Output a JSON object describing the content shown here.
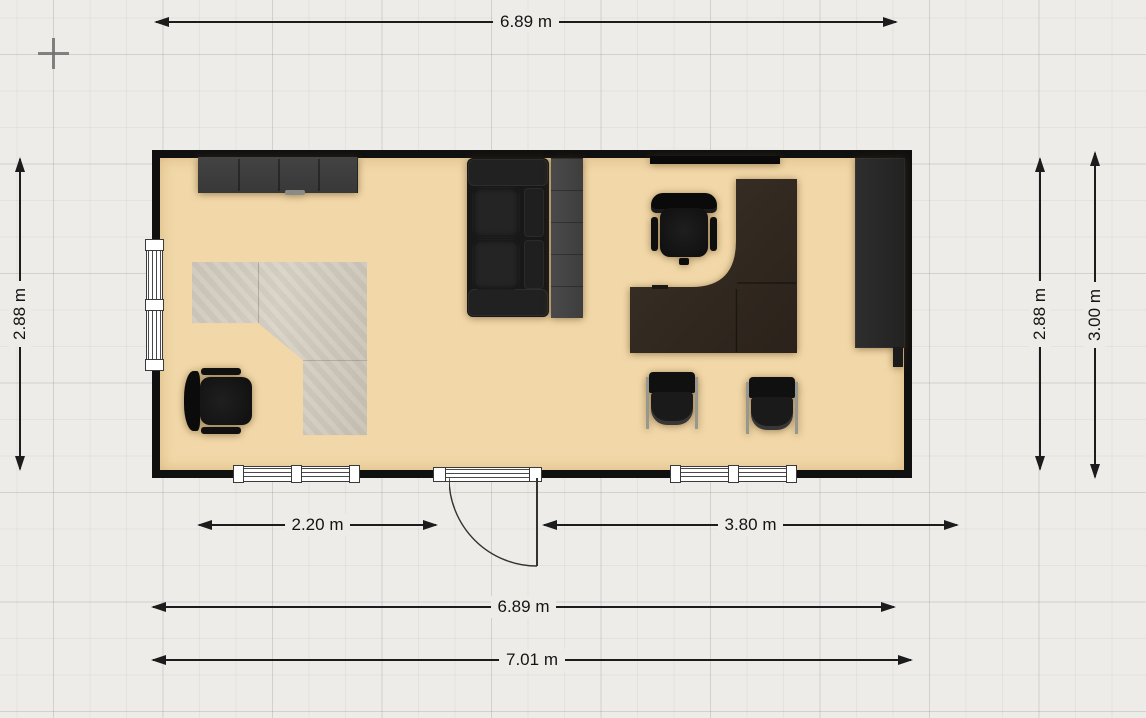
{
  "plan": {
    "units": "m",
    "dimensions": {
      "top_width": "6.89 m",
      "left_height": "2.88 m",
      "bottom_segment_left": "2.20 m",
      "bottom_segment_right": "3.80 m",
      "bottom_inner_width": "6.89 m",
      "bottom_outer_width": "7.01 m",
      "right_inner_height": "2.88 m",
      "right_outer_height": "3.00 m"
    },
    "room": {
      "floor_color": "#f2d8a8",
      "wall_color": "#101010",
      "windows_count": 3,
      "doors_count": 1
    },
    "furniture": [
      "sideboard",
      "corner-desk-light",
      "office-chair-left",
      "sofa",
      "bookcase",
      "wall-board",
      "corner-desk-dark",
      "office-chair-right",
      "visitor-chair-1",
      "visitor-chair-2",
      "tall-cabinet"
    ]
  }
}
